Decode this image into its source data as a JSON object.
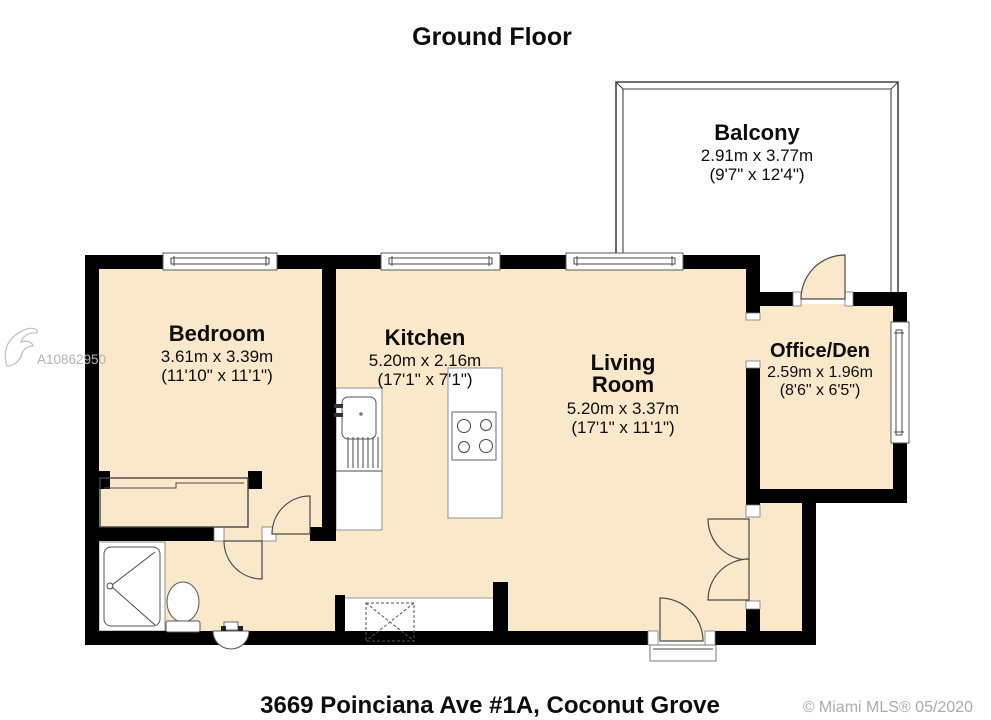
{
  "title": "Ground Floor",
  "rooms": [
    {
      "name": "Balcony",
      "metric": "2.91m x 3.77m",
      "imperial": "(9'7\" x 12'4\")"
    },
    {
      "name": "Bedroom",
      "metric": "3.61m x 3.39m",
      "imperial": "(11'10\" x 11'1\")"
    },
    {
      "name": "Kitchen",
      "metric": "5.20m x 2.16m",
      "imperial": "(17'1\" x 7'1\")"
    },
    {
      "name": "Living Room",
      "lines": [
        "Living",
        "Room"
      ],
      "metric": "5.20m x 3.37m",
      "imperial": "(17'1\" x 11'1\")"
    },
    {
      "name": "Office/Den",
      "metric": "2.59m x 1.96m",
      "imperial": "(8'6\" x 6'5\")"
    }
  ],
  "footer": {
    "address": "3669 Poinciana Ave #1A, Coconut Grove",
    "copyright": "© Miami MLS® 05/2020"
  },
  "watermark": "A10862950",
  "colors": {
    "floor": "#FAE8CB",
    "wall": "#000000",
    "watermark_gray": "#B3B3B3",
    "copyright_gray": "#ABABAB"
  },
  "fixtures": [
    "shower",
    "toilet",
    "pedestal-sink",
    "kitchen-sink",
    "kitchen-counter",
    "island-cooktop",
    "washer-dryer",
    "bedroom-closet",
    "laundry-closet",
    "entry-threshold",
    "balcony-railing",
    "windows",
    "door-swings"
  ]
}
